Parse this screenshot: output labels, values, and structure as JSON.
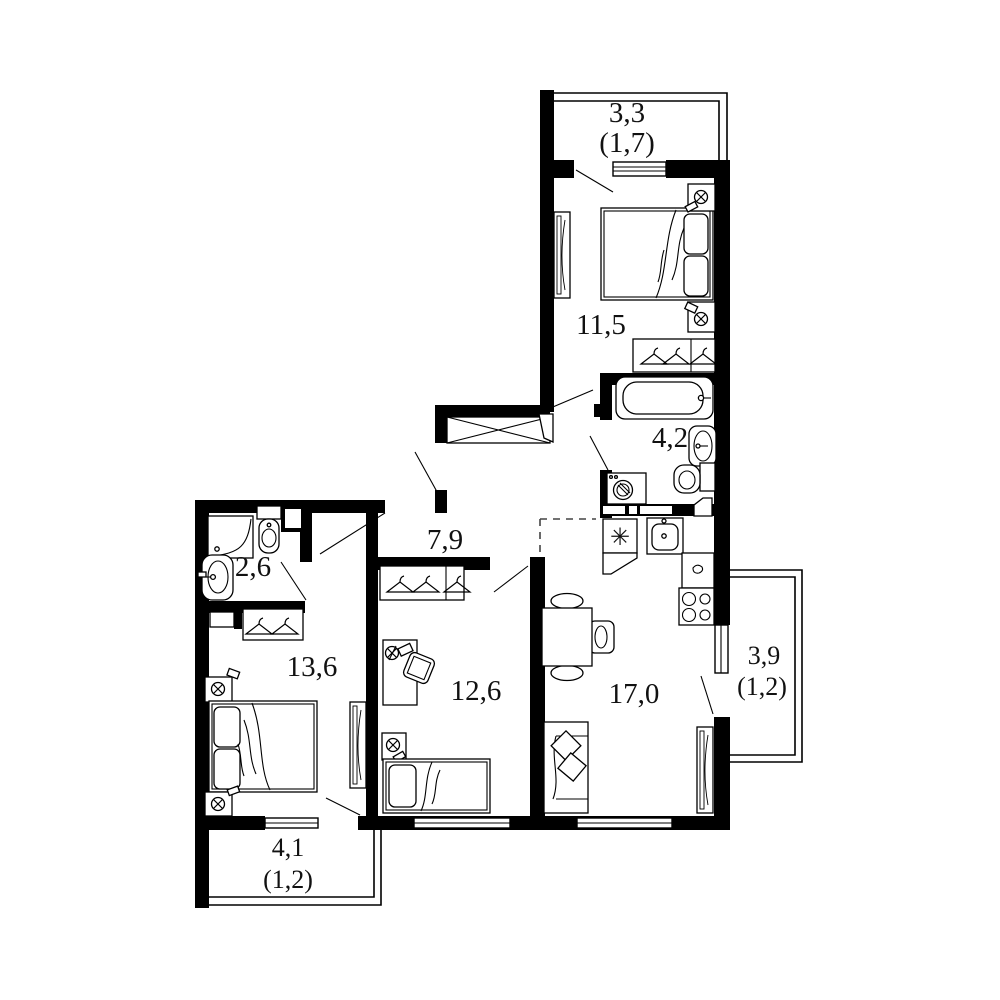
{
  "document": {
    "type": "apartment-floor-plan",
    "background": "#ffffff"
  },
  "colors": {
    "walls": "#000000",
    "lines": "#1a1a1a",
    "background": "#ffffff",
    "dashed_zone_line": "#444444"
  },
  "rooms": {
    "balcony_top": {
      "area": "3,3",
      "area_reduced": "(1,7)"
    },
    "bedroom_right": {
      "area": "11,5"
    },
    "bathroom_large": {
      "area": "4,2"
    },
    "hallway": {
      "area": "7,9"
    },
    "bathroom_small": {
      "area": "2,6"
    },
    "bedroom_left": {
      "area": "13,6"
    },
    "room_middle": {
      "area": "12,6"
    },
    "kitchen_living": {
      "area": "17,0"
    },
    "balcony_right": {
      "area": "3,9",
      "area_reduced": "(1,2)"
    },
    "balcony_bottom": {
      "area": "4,1",
      "area_reduced": "(1,2)"
    }
  },
  "symbols": {
    "fridge_snowflake": "✳",
    "lamp": "circle-with-diagonal-cross",
    "hanger": "triangle-with-hook",
    "ventilation_shaft": "crossed-box"
  }
}
